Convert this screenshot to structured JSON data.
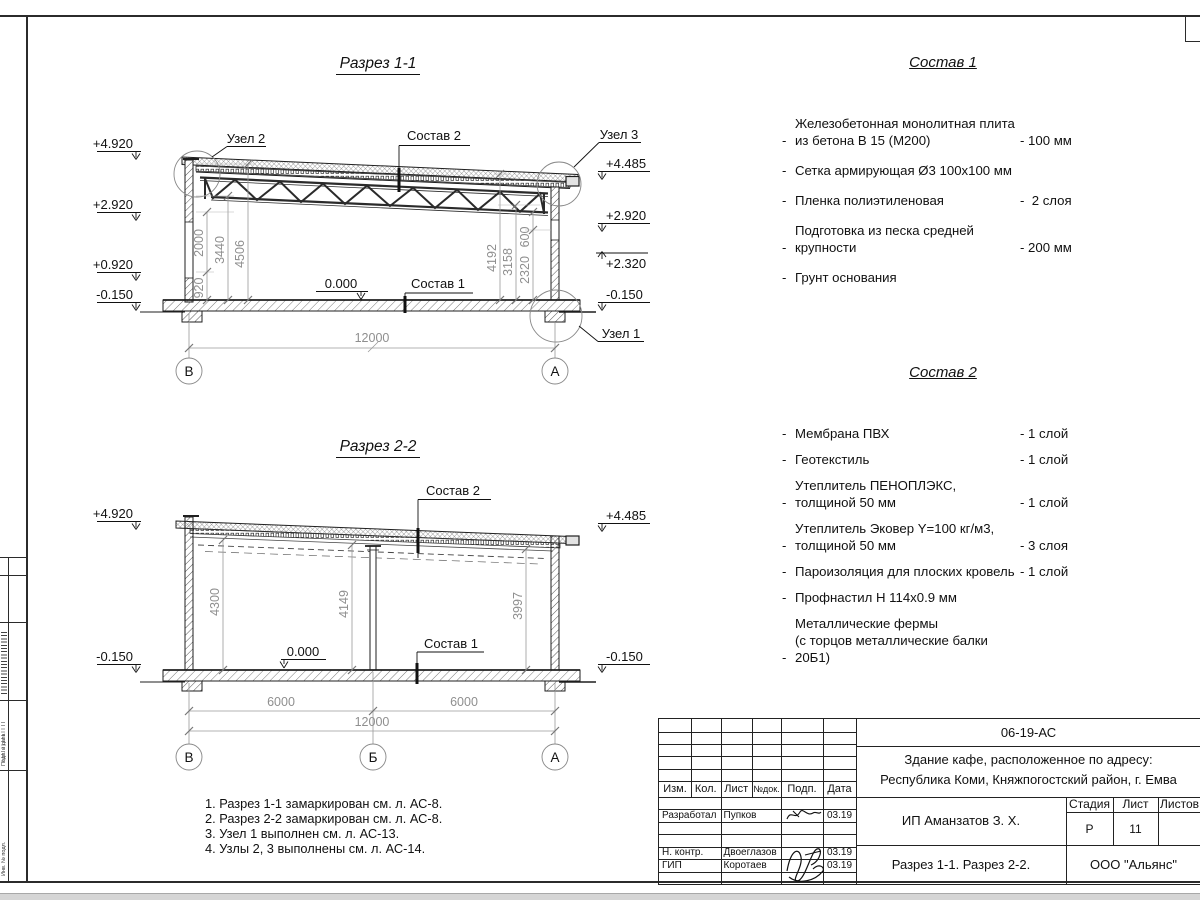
{
  "s1": {
    "title": "Разрез 1-1",
    "node1": "Узел 1",
    "node2": "Узел 2",
    "node3": "Узел 3",
    "comp1": "Состав 1",
    "comp2": "Состав 2",
    "zero": "0.000",
    "elev_left": [
      "+4.920",
      "+2.920",
      "+0.920",
      "-0.150"
    ],
    "elev_right": [
      "+4.485",
      "+2.920",
      "+2.320",
      "-0.150"
    ],
    "dims_left": [
      "920",
      "2000",
      "3440",
      "4506"
    ],
    "dims_right": [
      "2320",
      "600",
      "3158",
      "4192"
    ],
    "dim_total": "12000",
    "axis_left": "В",
    "axis_right": "А"
  },
  "s2": {
    "title": "Разрез 2-2",
    "comp1": "Состав 1",
    "comp2": "Состав 2",
    "zero": "0.000",
    "elev_left": [
      "+4.920",
      "-0.150"
    ],
    "elev_right": [
      "+4.485",
      "-0.150"
    ],
    "dims_vert": [
      "4300",
      "4149",
      "3997"
    ],
    "dims_bottom": [
      "6000",
      "6000"
    ],
    "dim_total": "12000",
    "axes": [
      "В",
      "Б",
      "А"
    ]
  },
  "list_dash": "-",
  "comp1": {
    "title": "Состав 1",
    "items": [
      {
        "name": "Железобетонная  монолитная плита\nиз бетона В 15 (М200)",
        "value": "- 100 мм"
      },
      {
        "name": "Сетка армирующая Ø3 100х100 мм",
        "value": ""
      },
      {
        "name": "Пленка полиэтиленовая",
        "value": "-  2 слоя"
      },
      {
        "name": "Подготовка из песка средней\nкрупности",
        "value": "- 200 мм"
      },
      {
        "name": "Грунт основания",
        "value": ""
      }
    ]
  },
  "comp2": {
    "title": "Состав 2",
    "items": [
      {
        "name": "Мембрана ПВХ",
        "value": "- 1 слой"
      },
      {
        "name": "Геотекстиль",
        "value": "- 1 слой"
      },
      {
        "name": "Утеплитель ПЕНОПЛЭКС,\nтолщиной 50 мм",
        "value": "- 1 слой"
      },
      {
        "name": "Утеплитель Эковер Y=100 кг/м3,\nтолщиной 50 мм",
        "value": "- 3 слоя"
      },
      {
        "name": "Пароизоляция для плоских кровель",
        "value": "- 1 слой"
      },
      {
        "name": "Профнастил Н 114х0.9 мм",
        "value": ""
      },
      {
        "name": "Металлические фермы\n(с торцов металлические балки 20Б1)",
        "value": ""
      }
    ]
  },
  "notes": [
    "1. Разрез 1-1 замаркирован см. л. АС-8.",
    "2. Разрез 2-2 замаркирован см. л. АС-8.",
    "3. Узел 1 выполнен см. л. АС-13.",
    "4. Узлы 2, 3 выполнены см. л. АС-14."
  ],
  "tb": {
    "doc": "06-19-АС",
    "object1": "Здание кафе, расположенное по адресу:",
    "object2": "Республика Коми, Княжпогостский район, г. Емва",
    "client": "ИП Аманзатов З. Х.",
    "sheet_name": "Разрез 1-1. Разрез 2-2.",
    "org": "ООО \"Альянс\"",
    "cols": {
      "izm": "Изм.",
      "kol": "Кол.",
      "list": "Лист",
      "ndok": "№док.",
      "podp": "Подп.",
      "data": "Дата"
    },
    "stage_h": "Стадия",
    "list_h": "Лист",
    "listov_h": "Листов",
    "stage": "Р",
    "list_no": "11",
    "rows": [
      {
        "role": "Разработал",
        "name": "Пупков",
        "date": "03.19"
      },
      {
        "role": "Н. контр.",
        "name": "Двоеглазов",
        "date": "03.19"
      },
      {
        "role": "ГИП",
        "name": "Коротаев",
        "date": "03.19"
      }
    ]
  },
  "side_stamp": {
    "labels": [
      "Подп. и дата",
      "Инв. № подл."
    ]
  }
}
